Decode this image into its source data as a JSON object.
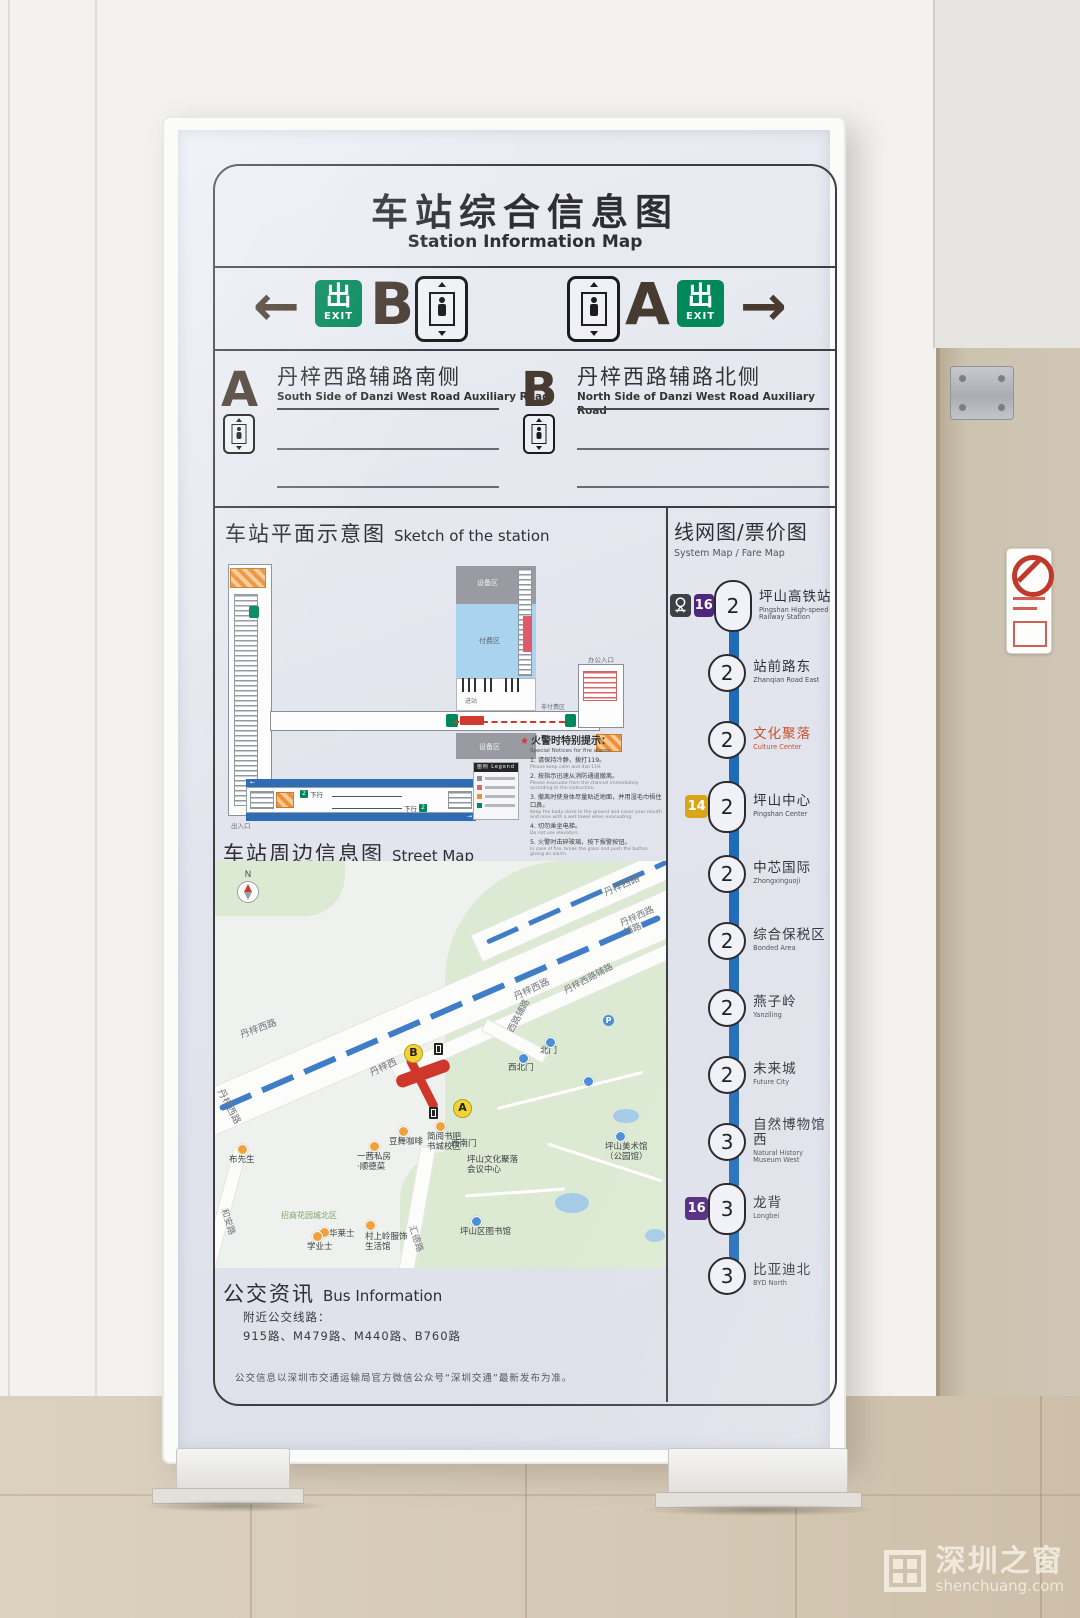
{
  "scene": {
    "watermark": {
      "cn": "深圳之窗",
      "en": "shenchuang.com"
    }
  },
  "sign": {
    "title_cn": "车站综合信息图",
    "title_en": "Station Information Map",
    "exit_bar": {
      "left_arrow": "←",
      "right_arrow": "→",
      "left_letter": "B",
      "right_letter": "A",
      "exit_cn": "出",
      "exit_en": "EXIT"
    },
    "exit_info": [
      {
        "letter": "A",
        "cn": "丹梓西路辅路南侧",
        "en": "South Side of Danzi West Road Auxiliary Road"
      },
      {
        "letter": "B",
        "cn": "丹梓西路辅路北侧",
        "en": "North Side of Danzi West Road Auxiliary Road"
      }
    ],
    "sketch": {
      "title_cn": "车站平面示意图",
      "title_en": "Sketch of the station",
      "area_labels": {
        "equip_top": "设备区",
        "paid": "付费区",
        "gates": "进站",
        "unpaid": "非付费区",
        "equip_bottom": "设备区",
        "office": "办公入口",
        "entrance": "出入口"
      },
      "notice": {
        "title_cn": "火警时特别提示：",
        "title_en": "Special Notices for fire alarm:",
        "items": [
          {
            "cn": "1. 请保持冷静，拨打119。",
            "en": "Please keep calm and dial 119."
          },
          {
            "cn": "2. 按指示迅速从消防通道撤离。",
            "en": "Please evacuate from the channel immediately according to the instruction."
          },
          {
            "cn": "3. 撤离时使身体尽量贴近地面，并用湿毛巾捂住口鼻。",
            "en": "Keep the body close to the ground and cover your mouth and nose with a wet towel when evacuating."
          },
          {
            "cn": "4. 切勿乘坐电梯。",
            "en": "Do not use elevators."
          },
          {
            "cn": "5. 火警时击碎玻璃，按下报警按钮。",
            "en": "In case of fire, break the glass and push the button giving an alarm."
          }
        ]
      },
      "platform": {
        "down_label": "下行",
        "zone": "2",
        "legend_cn": "图例",
        "legend_en": "Legend"
      }
    },
    "system_map": {
      "title_cn": "线网图/票价图",
      "title_en": "System Map / Fare Map",
      "line_color": "#1e6bb8",
      "badges": {
        "14": {
          "label": "14",
          "color": "#d8a51d"
        },
        "16": {
          "label": "16",
          "color": "#50267d"
        },
        "rail": {
          "label": "railway-logo",
          "color": "#3f3f46"
        }
      },
      "stations": [
        {
          "cn": "坪山高铁站",
          "en": "Pingshan High-speed Railway Station",
          "fare": "2",
          "interchange": true,
          "current": false,
          "badges": [
            "rail",
            "16"
          ]
        },
        {
          "cn": "站前路东",
          "en": "Zhanqian Road East",
          "fare": "2",
          "interchange": false,
          "current": false,
          "badges": []
        },
        {
          "cn": "文化聚落",
          "en": "Culture Center",
          "fare": "2",
          "interchange": false,
          "current": true,
          "badges": []
        },
        {
          "cn": "坪山中心",
          "en": "Pingshan Center",
          "fare": "2",
          "interchange": true,
          "current": false,
          "badges": [
            "14"
          ]
        },
        {
          "cn": "中芯国际",
          "en": "Zhongxinguoji",
          "fare": "2",
          "interchange": false,
          "current": false,
          "badges": []
        },
        {
          "cn": "综合保税区",
          "en": "Bonded Area",
          "fare": "2",
          "interchange": false,
          "current": false,
          "badges": []
        },
        {
          "cn": "燕子岭",
          "en": "Yanziling",
          "fare": "2",
          "interchange": false,
          "current": false,
          "badges": []
        },
        {
          "cn": "未来城",
          "en": "Future City",
          "fare": "2",
          "interchange": false,
          "current": false,
          "badges": []
        },
        {
          "cn": "自然博物馆西",
          "en": "Natural History Museum West",
          "fare": "3",
          "interchange": false,
          "current": false,
          "badges": []
        },
        {
          "cn": "龙背",
          "en": "Longbei",
          "fare": "3",
          "interchange": true,
          "current": false,
          "badges": [
            "16"
          ]
        },
        {
          "cn": "比亚迪北",
          "en": "BYD North",
          "fare": "3",
          "interchange": false,
          "current": false,
          "badges": []
        }
      ]
    },
    "street_map": {
      "title_cn": "车站周边信息图",
      "title_en": "Street Map",
      "compass": "N",
      "exit_a": "A",
      "exit_b": "B",
      "labels": [
        {
          "t": "丹梓西路",
          "x": 390,
          "y": 28,
          "r": -24,
          "c": "#70757c",
          "s": 9.5
        },
        {
          "t": "丹梓西路辅路",
          "x": 408,
          "y": 58,
          "r": -24,
          "c": "#70757c",
          "s": 9
        },
        {
          "t": "丹梓西路",
          "x": 300,
          "y": 132,
          "r": -25,
          "c": "#70757c",
          "s": 9.5
        },
        {
          "t": "丹梓西路辅路",
          "x": 350,
          "y": 126,
          "r": -28,
          "c": "#70757c",
          "s": 9
        },
        {
          "t": "西路辅路",
          "x": 296,
          "y": 166,
          "r": -62,
          "c": "#70757c",
          "s": 9
        },
        {
          "t": "丹梓西",
          "x": 156,
          "y": 208,
          "r": -25,
          "c": "#70757c",
          "s": 9.5
        },
        {
          "t": "丹梓西路",
          "x": 26,
          "y": 170,
          "r": -20,
          "c": "#70757c",
          "s": 9.5
        },
        {
          "t": "丹梓西路",
          "x": 4,
          "y": 224,
          "r": 62,
          "c": "#70757c",
          "s": 9.5
        },
        {
          "t": "北门",
          "x": 325,
          "y": 186
        },
        {
          "t": "西北门",
          "x": 293,
          "y": 203
        },
        {
          "t": "坪山美术馆\n（公园馆）",
          "x": 390,
          "y": 282
        },
        {
          "t": "西南门",
          "x": 236,
          "y": 279
        },
        {
          "t": "坪山文化聚落\n会议中心",
          "x": 252,
          "y": 295
        },
        {
          "t": "坪山区图书馆",
          "x": 245,
          "y": 367
        },
        {
          "t": "简阅书吧\n书城校区",
          "x": 212,
          "y": 272
        },
        {
          "t": "豆舞咖啡",
          "x": 174,
          "y": 277
        },
        {
          "t": "一茜私房\n·顺德菜",
          "x": 142,
          "y": 292
        },
        {
          "t": "招商花园城北区",
          "x": 66,
          "y": 350,
          "c": "#7fa36b",
          "s": 8
        },
        {
          "t": "华莱士",
          "x": 114,
          "y": 369
        },
        {
          "t": "村上岭服饰\n生活馆",
          "x": 150,
          "y": 372
        },
        {
          "t": "汇德路",
          "x": 196,
          "y": 360,
          "r": 72,
          "c": "#70757c",
          "s": 9
        },
        {
          "t": "和安路",
          "x": 8,
          "y": 343,
          "r": 72,
          "c": "#70757c",
          "s": 9
        },
        {
          "t": "布先生",
          "x": 14,
          "y": 295
        },
        {
          "t": "学业士",
          "x": 92,
          "y": 382
        },
        {
          "t": "",
          "i": "blue",
          "x": 330,
          "y": 176
        },
        {
          "t": "",
          "i": "blue",
          "x": 303,
          "y": 192
        },
        {
          "t": "",
          "i": "p",
          "x": 388,
          "y": 154
        },
        {
          "t": "",
          "i": "blue",
          "x": 368,
          "y": 215
        },
        {
          "t": "",
          "i": "blue",
          "x": 256,
          "y": 355
        },
        {
          "t": "",
          "i": "blue",
          "x": 400,
          "y": 270
        },
        {
          "t": "",
          "i": "orange",
          "x": 183,
          "y": 265
        },
        {
          "t": "",
          "i": "orange",
          "x": 220,
          "y": 260
        },
        {
          "t": "",
          "i": "orange",
          "x": 154,
          "y": 280
        },
        {
          "t": "",
          "i": "orange",
          "x": 150,
          "y": 359
        },
        {
          "t": "",
          "i": "orange",
          "x": 104,
          "y": 366
        },
        {
          "t": "",
          "i": "orange",
          "x": 22,
          "y": 283
        },
        {
          "t": "",
          "i": "orange",
          "x": 97,
          "y": 370
        }
      ]
    },
    "bus_info": {
      "title_cn": "公交资讯",
      "title_en": "Bus Information",
      "nearby_label": "附近公交线路：",
      "routes": "915路、M479路、M440路、B760路"
    },
    "footer_note": "公交信息以深圳市交通运输局官方微信公众号“深圳交通”最新发布为准。"
  }
}
